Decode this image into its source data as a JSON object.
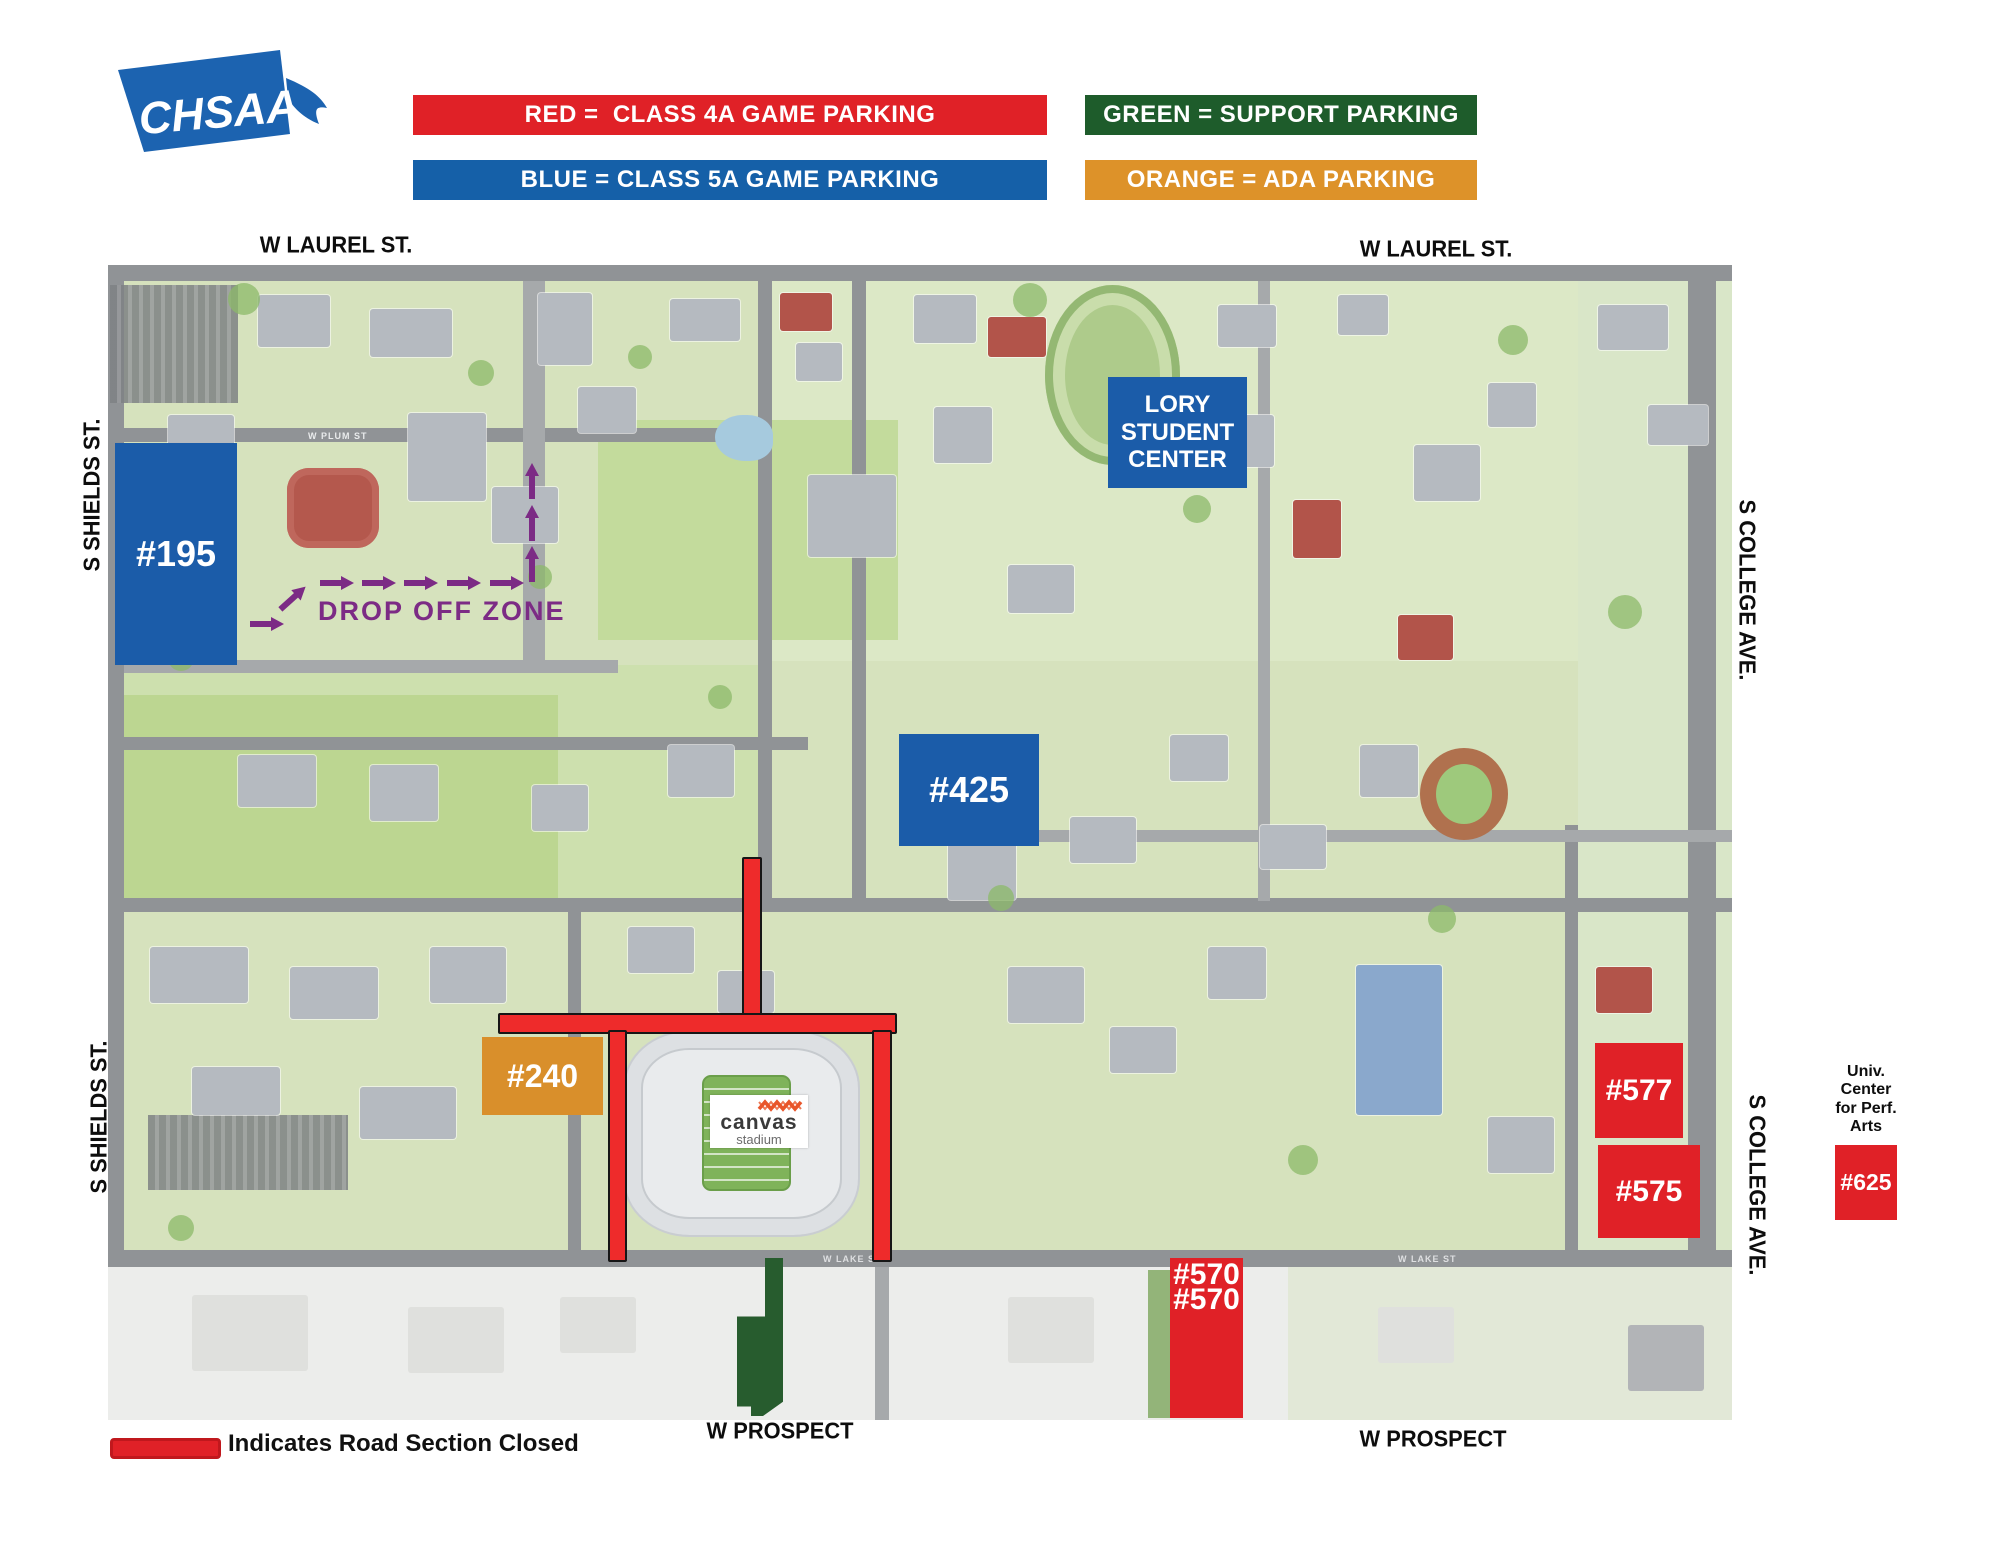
{
  "logo": {
    "text": "CHSAA"
  },
  "legend": {
    "red": "RED =  CLASS 4A GAME PARKING",
    "blue": "BLUE = CLASS 5A GAME PARKING",
    "green": "GREEN = SUPPORT PARKING",
    "orange": "ORANGE = ADA PARKING"
  },
  "colors": {
    "class_4a_red": "#e02127",
    "class_5a_blue": "#1560a8",
    "support_green": "#1e5c2b",
    "ada_orange": "#dd9229",
    "drop_off_purple": "#7c2b85",
    "road_closed_red": "#ee2b2b"
  },
  "streets": {
    "laurel_left": "W LAUREL ST.",
    "laurel_right": "W LAUREL ST.",
    "shields_top": "S SHIELDS ST.",
    "shields_bottom": "S SHIELDS ST.",
    "college_top": "S COLLEGE AVE.",
    "college_bottom": "S COLLEGE AVE.",
    "prospect_left": "W PROSPECT",
    "prospect_right": "W PROSPECT",
    "plum": "W PLUM ST",
    "lake_1": "W LAKE ST",
    "lake_2": "W LAKE ST"
  },
  "lots": {
    "p195": "#195",
    "p425": "#425",
    "p240": "#240",
    "p577": "#577",
    "p575": "#575",
    "p570": "#570",
    "p625": "#625"
  },
  "lory": {
    "line1": "LORY",
    "line2": "STUDENT",
    "line3": "CENTER"
  },
  "drop_off_zone": "DROP OFF ZONE",
  "univ_center": {
    "line1": "Univ.",
    "line2": "Center",
    "line3": "for Perf.",
    "line4": "Arts"
  },
  "stadium": {
    "name": "canvas",
    "sub": "stadium"
  },
  "footer": {
    "closure_label": "Indicates Road Section Closed"
  }
}
